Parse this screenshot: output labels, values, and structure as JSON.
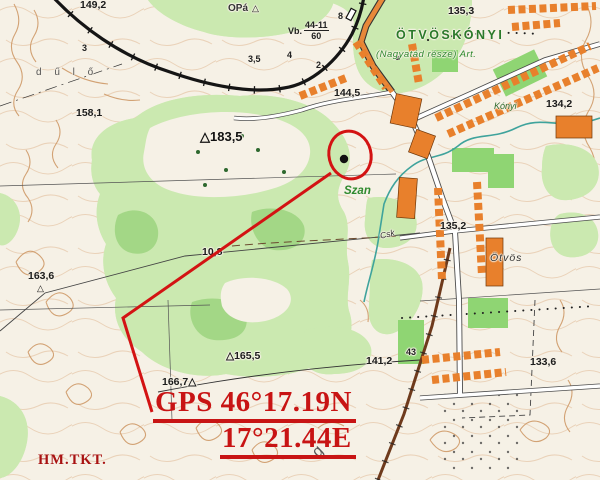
{
  "annotation": {
    "gps_line1": "GPS 46°17.19N",
    "gps_line2": "17°21.44E",
    "credit": "HM.TKT."
  },
  "places": {
    "village_name": "ÖTVÖSKÓNYI",
    "village_subtitle": "(Nagyatád része) Art.",
    "district_konyi": "Kónyi",
    "district_otvos": "Ötvös",
    "farm_szan": "Szan",
    "field_dulo": "d ű l ő",
    "op_marker": "OPá",
    "triangle": "△",
    "channel_csk": "Csk",
    "letter_g": "g"
  },
  "bridge_marker": {
    "prefix": "Vb.",
    "top": "44-11",
    "bottom": "60"
  },
  "spot_heights": {
    "nw_1492": "149,2",
    "ne_1353": "135,3",
    "w_1581": "158,1",
    "c_1445": "144,5",
    "hill_1835": "△183,5",
    "e_1342": "134,2",
    "v_1352": "135,2",
    "sw_1636": "163,6",
    "track_108": "10,8",
    "s_1655": "△165,5",
    "s_1667": "166,7△",
    "sc_1412": "141,2",
    "se_1336": "133,6"
  },
  "small_numbers": {
    "n3": "3",
    "n35": "3,5",
    "n4": "4",
    "n2": "2",
    "n8": "8",
    "n43": "43"
  },
  "colors": {
    "annotation_red": "#c81414",
    "forest_green": "#cbe9b0",
    "building_orange": "#e8802c",
    "contour_tan": "#cf9a68"
  }
}
